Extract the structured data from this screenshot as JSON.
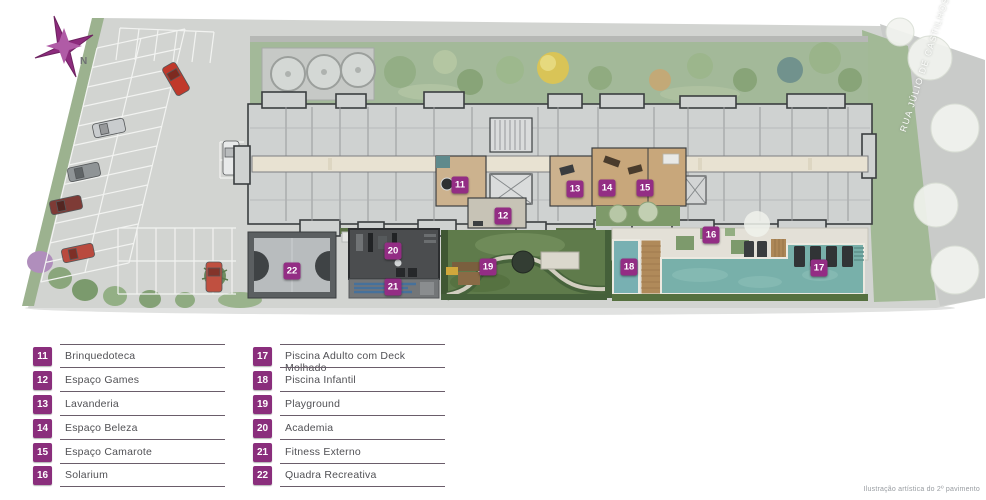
{
  "colors": {
    "accent_purple": "#8a2e7c",
    "plan_badge_purple": "#932d84",
    "pool_teal": "#78b0aa",
    "lawn_green": "#5f7b4b",
    "site_gray": "#d2d4d1"
  },
  "plan": {
    "compass_label": "N",
    "street_label": "RUA JÚLIO DE CASTILHOS",
    "caption": "Ilustração artística do 2º pavimento"
  },
  "legend": {
    "items": [
      {
        "number": "11",
        "label": "Brinquedoteca"
      },
      {
        "number": "12",
        "label": "Espaço Games"
      },
      {
        "number": "13",
        "label": "Lavanderia"
      },
      {
        "number": "14",
        "label": "Espaço Beleza"
      },
      {
        "number": "15",
        "label": "Espaço Camarote"
      },
      {
        "number": "16",
        "label": "Solarium"
      },
      {
        "number": "17",
        "label": "Piscina Adulto com Deck Molhado"
      },
      {
        "number": "18",
        "label": "Piscina Infantil"
      },
      {
        "number": "19",
        "label": "Playground"
      },
      {
        "number": "20",
        "label": "Academia"
      },
      {
        "number": "21",
        "label": "Fitness Externo"
      },
      {
        "number": "22",
        "label": "Quadra Recreativa"
      }
    ]
  }
}
